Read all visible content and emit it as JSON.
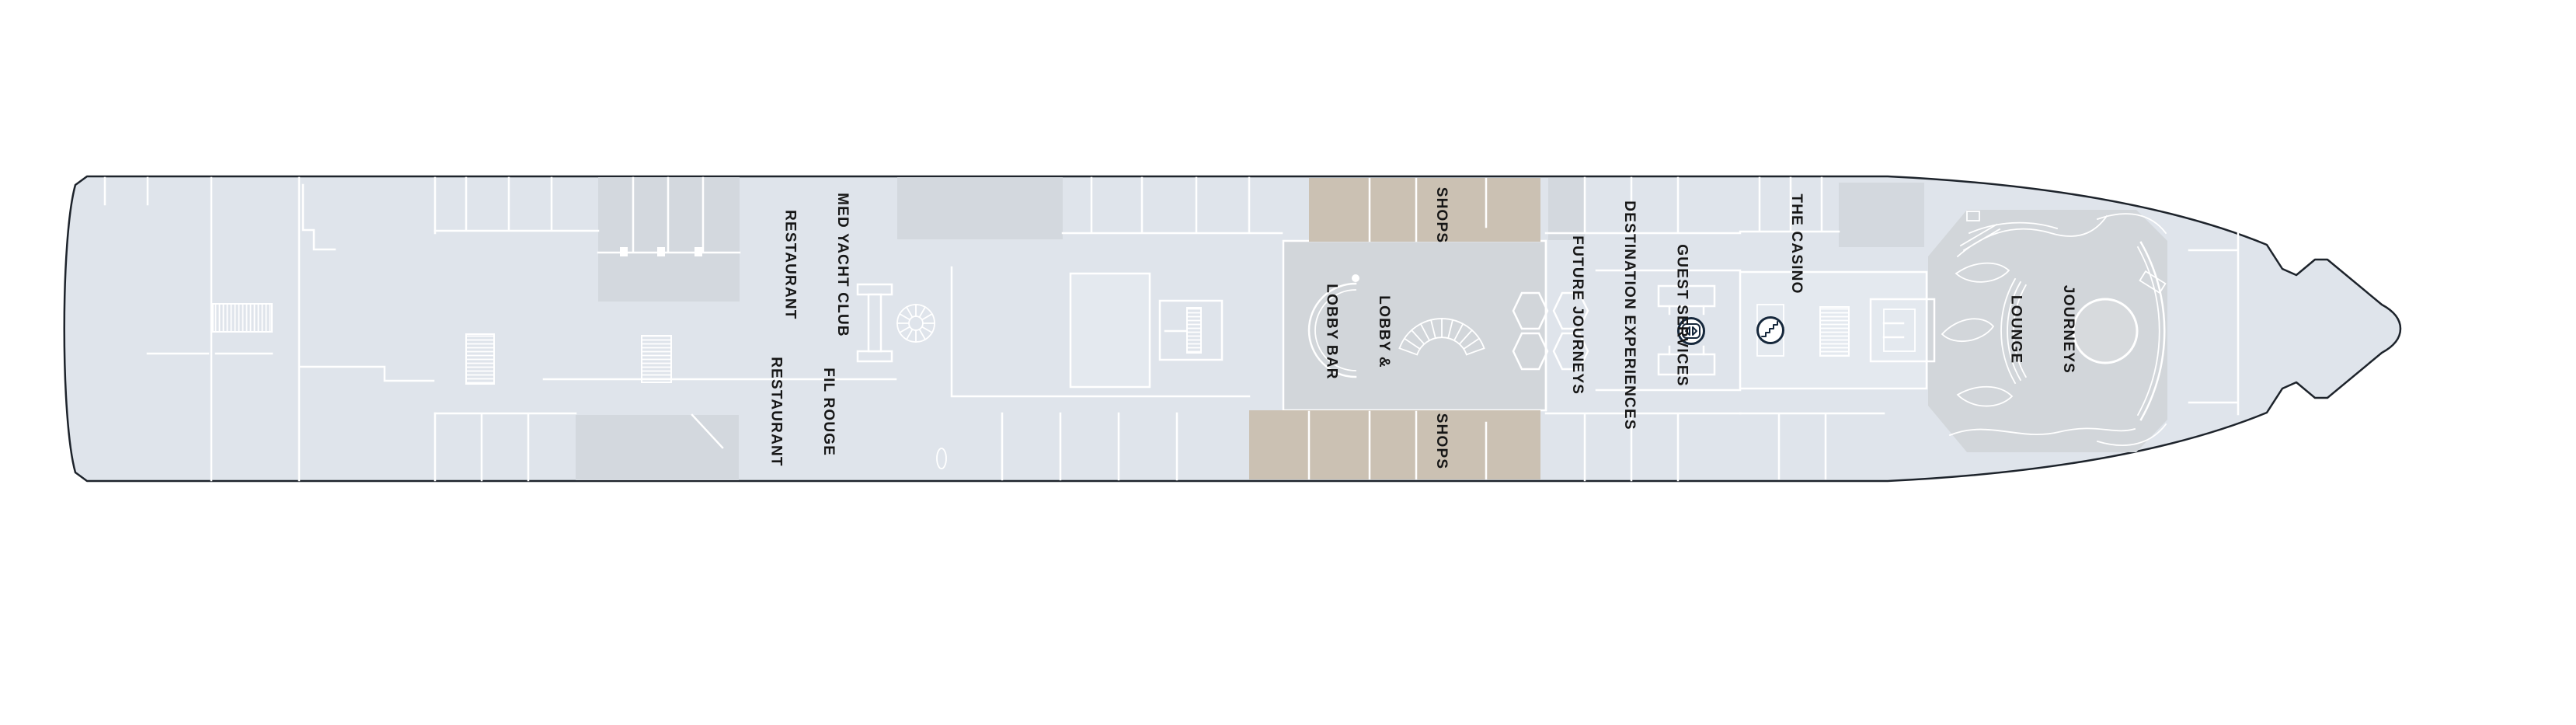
{
  "plan": {
    "labels": {
      "med_yacht_club": {
        "line1": "MED YACHT CLUB",
        "line2": "RESTAURANT"
      },
      "fil_rouge": {
        "line1": "FIL ROUGE",
        "line2": "RESTAURANT"
      },
      "lobby": {
        "line1": "LOBBY &",
        "line2": "LOBBY BAR"
      },
      "shops_top": {
        "line1": "SHOPS"
      },
      "shops_bottom": {
        "line1": "SHOPS"
      },
      "guest_services": {
        "line1": "GUEST SERVICES",
        "line2": "DESTINATION EXPERIENCES",
        "line3": "FUTURE JOURNEYS"
      },
      "casino": {
        "line1": "THE CASINO"
      },
      "journeys_lounge": {
        "line1": "JOURNEYS",
        "line2": "LOUNGE"
      }
    },
    "icons": {
      "elevator": "elevator-icon",
      "stairs": "stairs-icon"
    }
  },
  "theme": {
    "hull": "#dfe4eb",
    "room": "#d3d8de",
    "lobby": "#d2d6da",
    "shops_tan": "#cbc1b3",
    "light_room": "#e4e9ef",
    "wall": "#ffffff",
    "outline": "#1d232b",
    "icon_navy": "#16283c",
    "label_text": "#161616"
  }
}
